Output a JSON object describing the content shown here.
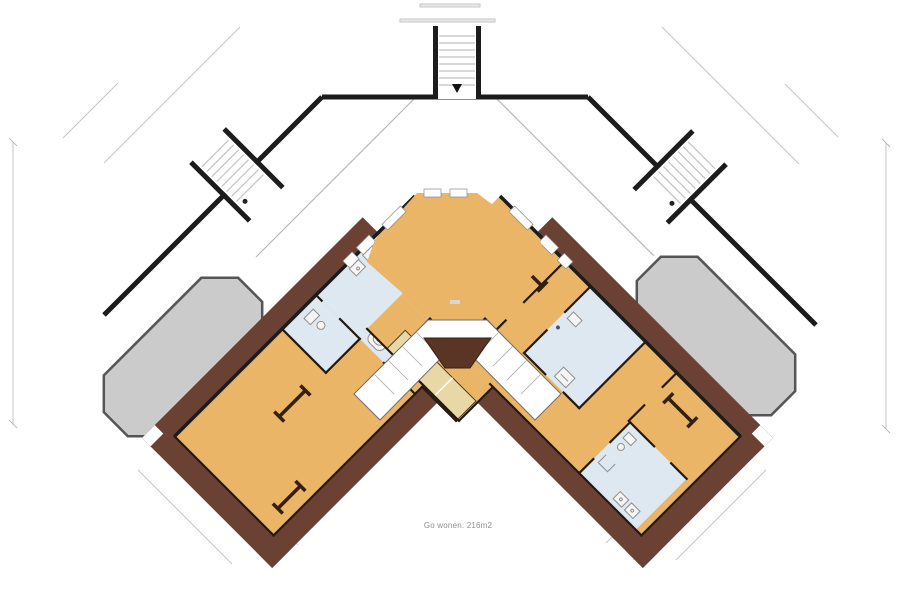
{
  "plan": {
    "caption": "Go wonen: 216m2",
    "area_value": "216m2",
    "floor_type": "floorplan"
  },
  "colors": {
    "page_bg": "#ffffff",
    "wall": "#1c1c1c",
    "roof_band": "#6b4134",
    "roof_dark": "#5a3425",
    "room": "#eab566",
    "wet_room": "#dde8f1",
    "cabinet": "#e8d8a6",
    "dormer": "#cbcbcb",
    "dormer_outline": "#555555",
    "dimension": "#c6c6c6",
    "stair_rung": "#c2c2c2",
    "label_text": "#8f8f8f"
  },
  "elements": {
    "staircases": [
      "top-center",
      "left-outer",
      "right-outer"
    ],
    "dormers": [
      "left",
      "right"
    ],
    "wet_rooms": 4,
    "cabinet_strips": 2,
    "roof_window_symbols": 4,
    "octagon_room_windows": 4
  }
}
